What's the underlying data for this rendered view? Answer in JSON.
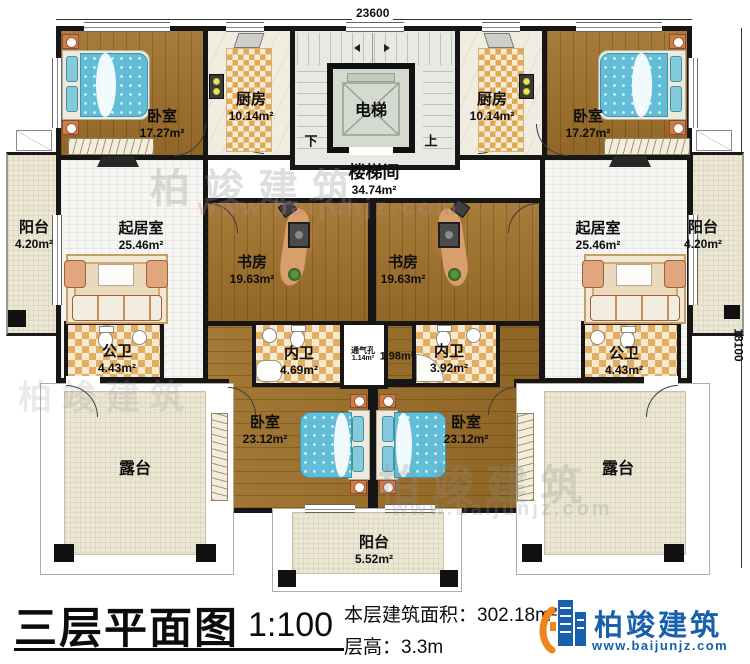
{
  "title_block": {
    "plan_title": "三层平面图",
    "scale": "1:100",
    "area_label": "本层建筑面积：",
    "area_value": "302.18m²",
    "floor_height_label": "层高：",
    "floor_height_value": "3.3m"
  },
  "logo": {
    "company": "柏竣建筑",
    "website": "www.baijunjz.com"
  },
  "dimensions": {
    "top_width": "23600",
    "right_height": "18100"
  },
  "stair_labels": {
    "down": "下",
    "up": "上"
  },
  "watermark": {
    "text": "柏竣建筑",
    "url": "www.baijunjz.com"
  },
  "rooms": {
    "bedroom_tl": {
      "name": "卧室",
      "area": "17.27m²"
    },
    "kitchen_l": {
      "name": "厨房",
      "area": "10.14m²"
    },
    "elevator": {
      "name": "电梯"
    },
    "stairwell": {
      "name": "楼梯间",
      "area": "34.74m²"
    },
    "kitchen_r": {
      "name": "厨房",
      "area": "10.14m²"
    },
    "bedroom_tr": {
      "name": "卧室",
      "area": "17.27m²"
    },
    "balcony_l": {
      "name": "阳台",
      "area": "4.20m²"
    },
    "living_l": {
      "name": "起居室",
      "area": "25.46m²"
    },
    "study_l": {
      "name": "书房",
      "area": "19.63m²"
    },
    "study_r": {
      "name": "书房",
      "area": "19.63m²"
    },
    "living_r": {
      "name": "起居室",
      "area": "25.46m²"
    },
    "balcony_r": {
      "name": "阳台",
      "area": "4.20m²"
    },
    "public_bath_l": {
      "name": "公卫",
      "area": "4.43m²"
    },
    "inner_bath_l": {
      "name": "内卫",
      "area": "4.69m²"
    },
    "vent": {
      "name": "通气孔",
      "area": "1.14m²"
    },
    "corridor": {
      "area": "1.98m²"
    },
    "inner_bath_r": {
      "name": "内卫",
      "area": "3.92m²"
    },
    "public_bath_r": {
      "name": "公卫",
      "area": "4.43m²"
    },
    "bedroom_bl": {
      "name": "卧室",
      "area": "23.12m²"
    },
    "bedroom_br": {
      "name": "卧室",
      "area": "23.12m²"
    },
    "balcony_b": {
      "name": "阳台",
      "area": "5.52m²"
    },
    "terrace_l": {
      "name": "露台"
    },
    "terrace_r": {
      "name": "露台"
    }
  },
  "colors": {
    "wall": "#161616",
    "wood_floor": "#a1722b",
    "tile": "#e3ae61",
    "bed_blue": "#63bdd6",
    "logo_blue": "#1760ac",
    "logo_orange": "#f08519"
  }
}
